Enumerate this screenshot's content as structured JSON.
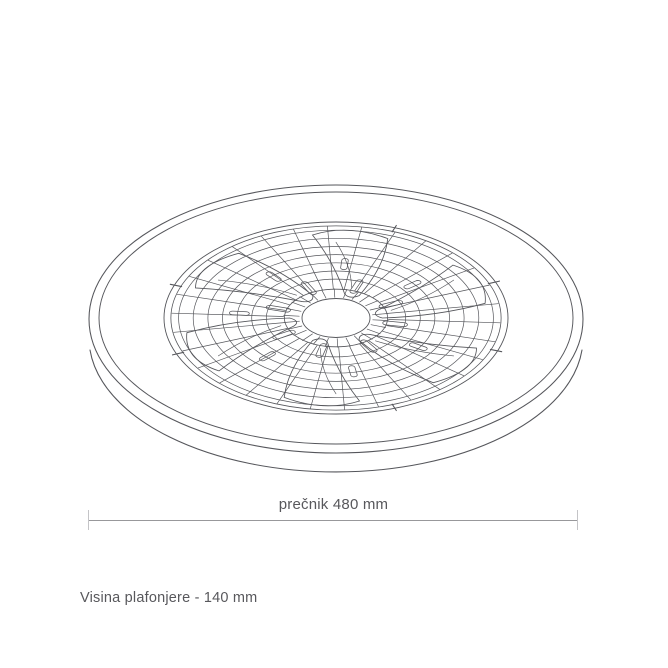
{
  "page": {
    "background": "#ffffff"
  },
  "drawing": {
    "subject": "ceiling-fan-light-wireframe",
    "line_color": "#55565b"
  },
  "dimension": {
    "diameter_label": "prečnik 480 mm",
    "height_label": "Visina plafonjere - 140 mm",
    "line_color": "#98989b",
    "tick_color": "#c4c4c7",
    "text_color": "#58585c"
  }
}
